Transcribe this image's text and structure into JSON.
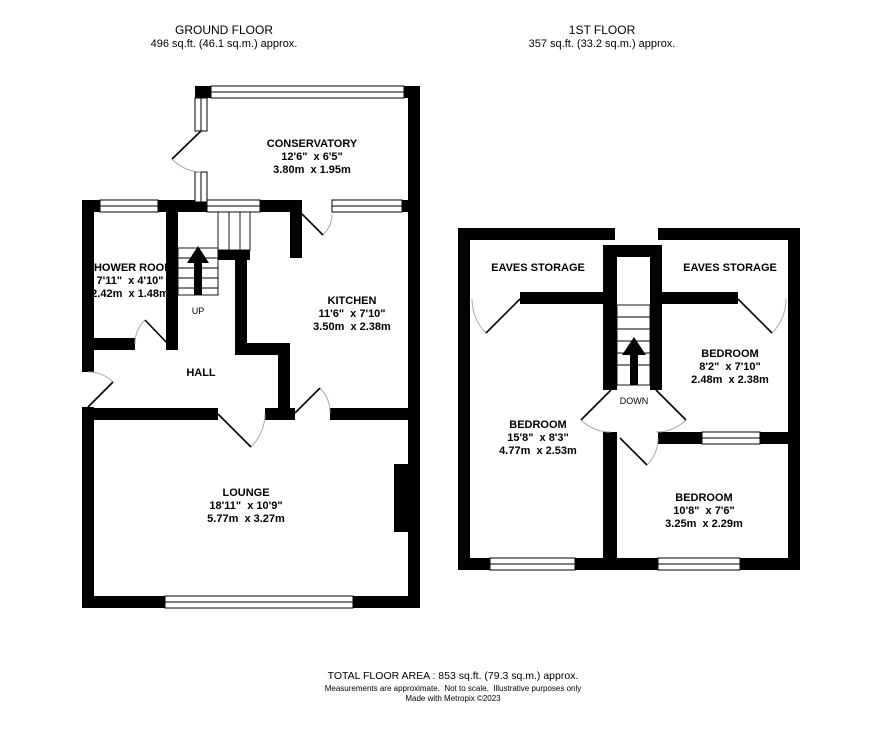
{
  "ground_floor": {
    "title": "GROUND FLOOR",
    "area": "496 sq.ft. (46.1 sq.m.) approx.",
    "stairs_label": "UP",
    "rooms": [
      {
        "name": "CONSERVATORY",
        "imperial": "12'6\"  x 6'5\"",
        "metric": "3.80m  x 1.95m"
      },
      {
        "name": "SHOWER ROOM",
        "imperial": "7'11\"  x 4'10\"",
        "metric": "2.42m  x 1.48m"
      },
      {
        "name": "KITCHEN",
        "imperial": "11'6\"  x 7'10\"",
        "metric": "3.50m  x 2.38m"
      },
      {
        "name": "HALL"
      },
      {
        "name": "LOUNGE",
        "imperial": "18'11\"  x 10'9\"",
        "metric": "5.77m  x 3.27m"
      }
    ]
  },
  "first_floor": {
    "title": "1ST FLOOR",
    "area": "357 sq.ft. (33.2 sq.m.) approx.",
    "stairs_label": "DOWN",
    "rooms": [
      {
        "name": "EAVES STORAGE"
      },
      {
        "name": "EAVES STORAGE"
      },
      {
        "name": "BEDROOM",
        "imperial": "15'8\"  x 8'3\"",
        "metric": "4.77m  x 2.53m"
      },
      {
        "name": "BEDROOM",
        "imperial": "8'2\"  x 7'10\"",
        "metric": "2.48m  x 2.38m"
      },
      {
        "name": "BEDROOM",
        "imperial": "10'8\"  x 7'6\"",
        "metric": "3.25m  x 2.29m"
      }
    ]
  },
  "footer": {
    "total_area": "TOTAL FLOOR AREA : 853 sq.ft. (79.3 sq.m.) approx.",
    "disclaimer": "Measurements are approximate.  Not to scale.  Illustrative purposes only",
    "credit": "Made with Metropix ©2023"
  },
  "icons": {
    "ground_stairs_arrow": "up-arrow",
    "first_stairs_arrow": "up-arrow"
  },
  "colors": {
    "wall": "#000000",
    "background": "#ffffff",
    "door_arc": "#aaaaaa"
  }
}
